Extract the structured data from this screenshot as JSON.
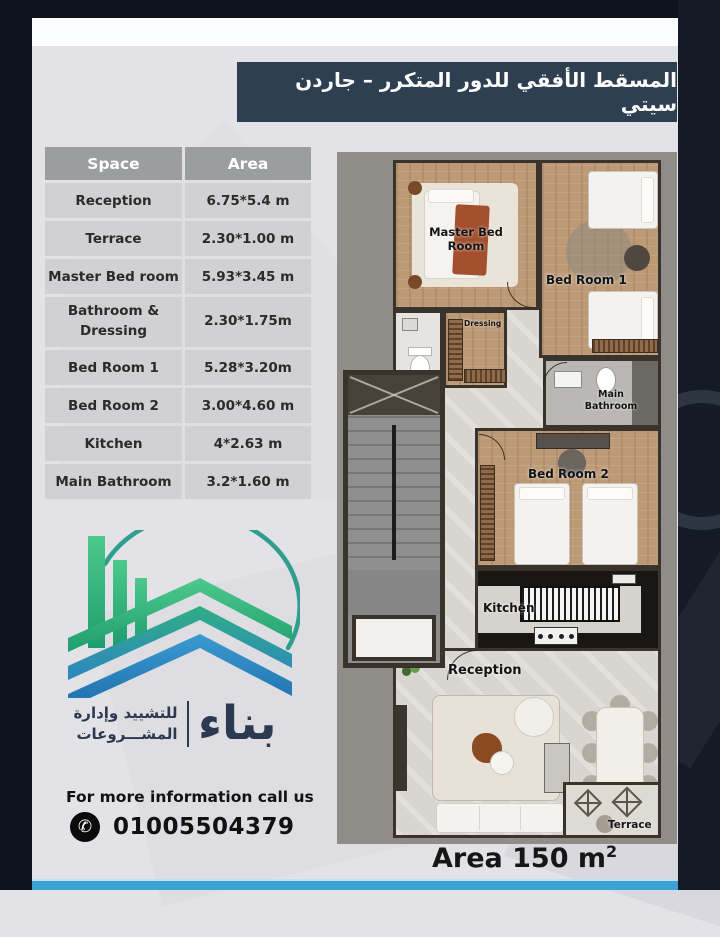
{
  "banner": {
    "title": "المسقط الأفقي للدور المتكرر – جاردن سيتي"
  },
  "table": {
    "headers": {
      "space": "Space",
      "area": "Area"
    },
    "rows": [
      {
        "space": "Reception",
        "area": "6.75*5.4 m"
      },
      {
        "space": "Terrace",
        "area": "2.30*1.00 m"
      },
      {
        "space": "Master Bed room",
        "area": "5.93*3.45 m"
      },
      {
        "space": "Bathroom &\nDressing",
        "area": "2.30*1.75m"
      },
      {
        "space": "Bed Room 1",
        "area": "5.28*3.20m"
      },
      {
        "space": "Bed Room 2",
        "area": "3.00*4.60 m"
      },
      {
        "space": "Kitchen",
        "area": "4*2.63 m"
      },
      {
        "space": "Main Bathroom",
        "area": "3.2*1.60 m"
      }
    ]
  },
  "logo": {
    "brand": "بناء",
    "tagline_line1": "للتشييد وإدارة",
    "tagline_line2": "المشـــروعات"
  },
  "contact": {
    "info": "For more information call us",
    "phone": "01005504379",
    "phone_icon_glyph": "✆"
  },
  "floorplan": {
    "labels": {
      "master": "Master Bed\nRoom",
      "bed1": "Bed Room 1",
      "dressing": "Dressing",
      "main_bath": "Main\nBathroom",
      "bed2": "Bed Room 2",
      "kitchen": "Kitchen",
      "reception": "Reception",
      "terrace": "Terrace"
    },
    "area_label": "Area 150 m",
    "area_sup": "2"
  },
  "colors": {
    "banner_bg": "#2d3f51",
    "bottom_strip": "#3ba2d4",
    "logo_green": "#36b380",
    "logo_blue": "#2e86c1",
    "frame_dark": "#0d131d",
    "wall": "#3a332c"
  }
}
